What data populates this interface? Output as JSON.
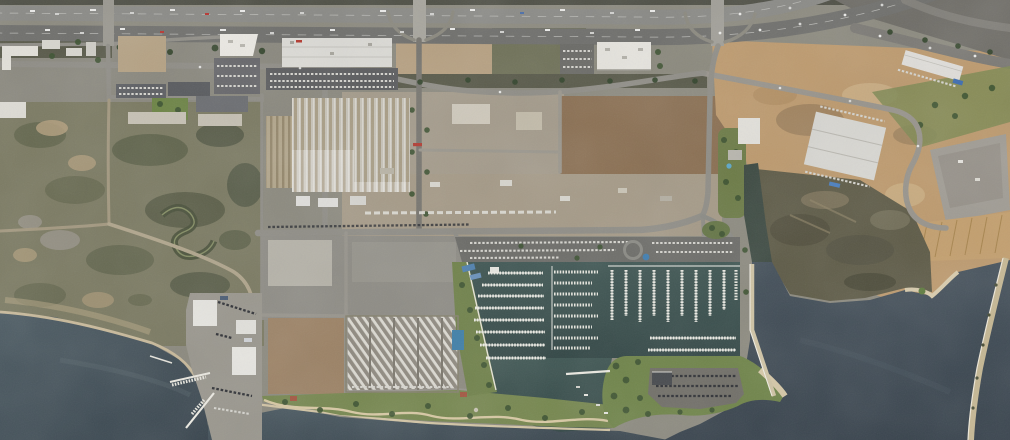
{
  "meta": {
    "title": "Aerial satellite view — bayfront industrial district and marina",
    "aria_label": "Satellite photograph: freeway corridor across the top, industrial buildings and graded dirt lots in the center, coastal scrubland at left, a marina with rows of boat docks at bottom center, shoreline parks, a boatyard, tidal wetland and a sand spit in dark bay water",
    "view_width": 1010,
    "view_height": 440
  },
  "palette": {
    "freeway_asphalt": "#757371",
    "surface_street": "#8f8d86",
    "dirt_lot": "#b19a7b",
    "graded_field": "#bd9a6e",
    "scrubland": "#7b7a62",
    "wetland": "#5e5b47",
    "bay_water": "#41505a",
    "marina_water": "#3b5452",
    "dock_white": "#e9e8e0",
    "park_green": "#76874f",
    "tree_green": "#3c5231",
    "roof_white": "#e4e2dc",
    "roof_corrugated": "#c7c3b8",
    "sand": "#d2c4a4"
  },
  "features": {
    "freeway": "freeway corridor with overpasses and traffic",
    "warehouse": "long white warehouse beside freeway",
    "factory": "industrial factory complex with corrugated roofs",
    "office_park": "office campus with green courtyard",
    "dirt_fields": "graded vacant dirt lots",
    "marina": "marina basin with finger docks and moored boats",
    "marina_parking": "marina parking lot with circular plaza",
    "peninsula": "landscaped peninsula with parking lot",
    "boatyard": "boatyard with piers and dry-stored boats",
    "rv_lot": "RV and boat storage rows",
    "park": "shoreline park with winding path",
    "scrubland": "coastal scrubland with winding dirt road",
    "wetland": "tidal mudflat and beach point",
    "sand_spit": "narrow sand spit in the bay"
  }
}
